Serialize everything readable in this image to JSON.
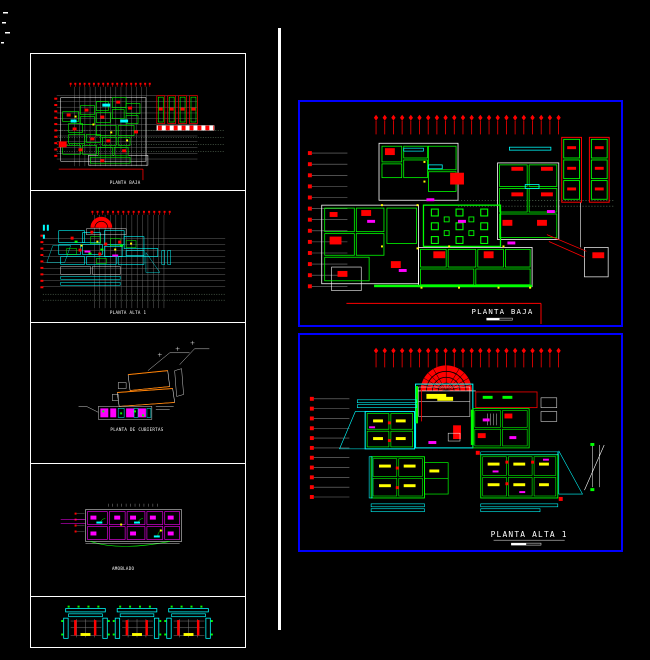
{
  "left_sheet": {
    "panels": [
      {
        "label": "PLANTA BAJA"
      },
      {
        "label": "PLANTA ALTA 1"
      },
      {
        "label": "PLANTA DE CUBIERTAS"
      },
      {
        "label": "AMOBLADO"
      },
      {
        "label": ""
      }
    ]
  },
  "right_sheets": [
    {
      "title": "PLANTA BAJA"
    },
    {
      "title": "PLANTA ALTA 1"
    }
  ],
  "colors": {
    "background": "#000000",
    "frame_white": "#ffffff",
    "frame_blue": "#0000ff",
    "cad_green": "#00ff00",
    "cad_red": "#ff0000",
    "cad_cyan": "#00ffff",
    "cad_yellow": "#ffff00",
    "cad_magenta": "#ff00ff",
    "cad_orange": "#ff7f00",
    "grid_gray": "#7d7d7d"
  }
}
